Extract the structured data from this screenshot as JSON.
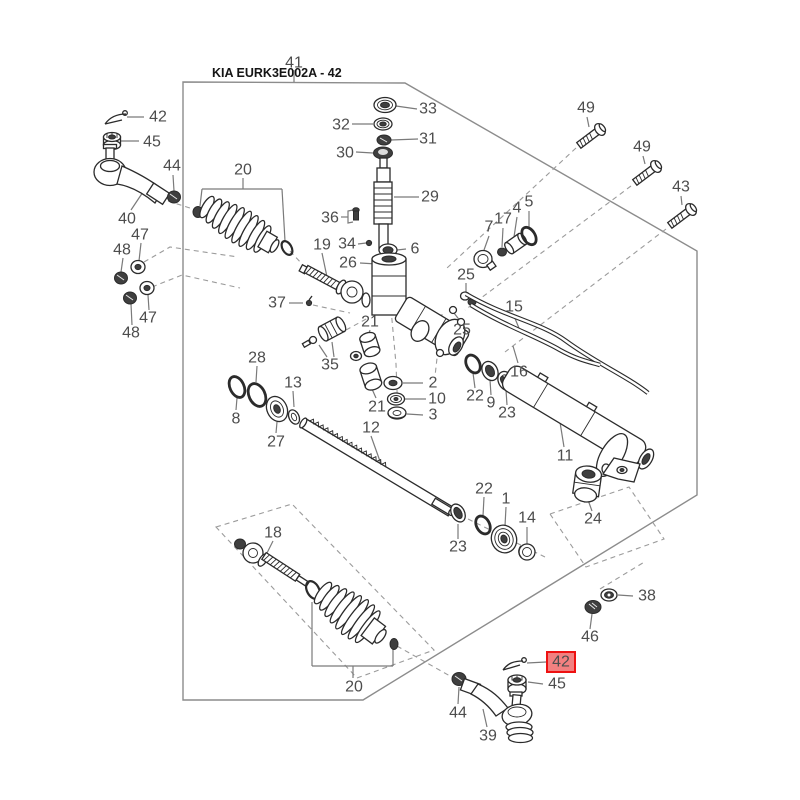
{
  "title": {
    "text": "KIA EURK3E002A - 42"
  },
  "highlight": {
    "fill": "#f28080",
    "border": "#ee1111",
    "text": "#8a2c2c"
  },
  "callouts": [
    {
      "label": "41",
      "x": 294,
      "y": 63
    },
    {
      "label": "42",
      "x": 158,
      "y": 117
    },
    {
      "label": "45",
      "x": 152,
      "y": 142
    },
    {
      "label": "44",
      "x": 172,
      "y": 166
    },
    {
      "label": "40",
      "x": 127,
      "y": 219
    },
    {
      "label": "20",
      "x": 243,
      "y": 170
    },
    {
      "label": "47",
      "x": 140,
      "y": 235
    },
    {
      "label": "48",
      "x": 122,
      "y": 250
    },
    {
      "label": "47",
      "x": 148,
      "y": 318
    },
    {
      "label": "48",
      "x": 131,
      "y": 333
    },
    {
      "label": "33",
      "x": 428,
      "y": 109
    },
    {
      "label": "32",
      "x": 341,
      "y": 125
    },
    {
      "label": "31",
      "x": 428,
      "y": 139
    },
    {
      "label": "30",
      "x": 345,
      "y": 153
    },
    {
      "label": "29",
      "x": 430,
      "y": 197
    },
    {
      "label": "36",
      "x": 330,
      "y": 218
    },
    {
      "label": "19",
      "x": 322,
      "y": 245
    },
    {
      "label": "34",
      "x": 347,
      "y": 244
    },
    {
      "label": "6",
      "x": 415,
      "y": 249
    },
    {
      "label": "26",
      "x": 348,
      "y": 263
    },
    {
      "label": "37",
      "x": 277,
      "y": 303
    },
    {
      "label": "7",
      "x": 489,
      "y": 227
    },
    {
      "label": "17",
      "x": 503,
      "y": 219
    },
    {
      "label": "4",
      "x": 517,
      "y": 208
    },
    {
      "label": "5",
      "x": 529,
      "y": 202
    },
    {
      "label": "25",
      "x": 466,
      "y": 275
    },
    {
      "label": "25",
      "x": 462,
      "y": 330
    },
    {
      "label": "15",
      "x": 514,
      "y": 307
    },
    {
      "label": "16",
      "x": 519,
      "y": 372
    },
    {
      "label": "49",
      "x": 586,
      "y": 108
    },
    {
      "label": "49",
      "x": 642,
      "y": 147
    },
    {
      "label": "43",
      "x": 681,
      "y": 187
    },
    {
      "label": "28",
      "x": 257,
      "y": 358
    },
    {
      "label": "8",
      "x": 236,
      "y": 419
    },
    {
      "label": "27",
      "x": 276,
      "y": 442
    },
    {
      "label": "13",
      "x": 293,
      "y": 383
    },
    {
      "label": "35",
      "x": 330,
      "y": 365
    },
    {
      "label": "21",
      "x": 370,
      "y": 322
    },
    {
      "label": "21",
      "x": 377,
      "y": 407
    },
    {
      "label": "12",
      "x": 371,
      "y": 428
    },
    {
      "label": "2",
      "x": 433,
      "y": 383
    },
    {
      "label": "10",
      "x": 437,
      "y": 399
    },
    {
      "label": "3",
      "x": 433,
      "y": 415
    },
    {
      "label": "22",
      "x": 475,
      "y": 396
    },
    {
      "label": "9",
      "x": 491,
      "y": 403
    },
    {
      "label": "23",
      "x": 507,
      "y": 413
    },
    {
      "label": "11",
      "x": 565,
      "y": 456
    },
    {
      "label": "22",
      "x": 484,
      "y": 489
    },
    {
      "label": "1",
      "x": 506,
      "y": 499
    },
    {
      "label": "14",
      "x": 527,
      "y": 518
    },
    {
      "label": "23",
      "x": 458,
      "y": 547
    },
    {
      "label": "24",
      "x": 593,
      "y": 519
    },
    {
      "label": "18",
      "x": 273,
      "y": 533
    },
    {
      "label": "20",
      "x": 354,
      "y": 687
    },
    {
      "label": "38",
      "x": 647,
      "y": 596
    },
    {
      "label": "46",
      "x": 590,
      "y": 637
    },
    {
      "label": "42",
      "x": 561,
      "y": 662,
      "highlight": true
    },
    {
      "label": "45",
      "x": 557,
      "y": 684
    },
    {
      "label": "44",
      "x": 458,
      "y": 713
    },
    {
      "label": "39",
      "x": 488,
      "y": 736
    }
  ]
}
